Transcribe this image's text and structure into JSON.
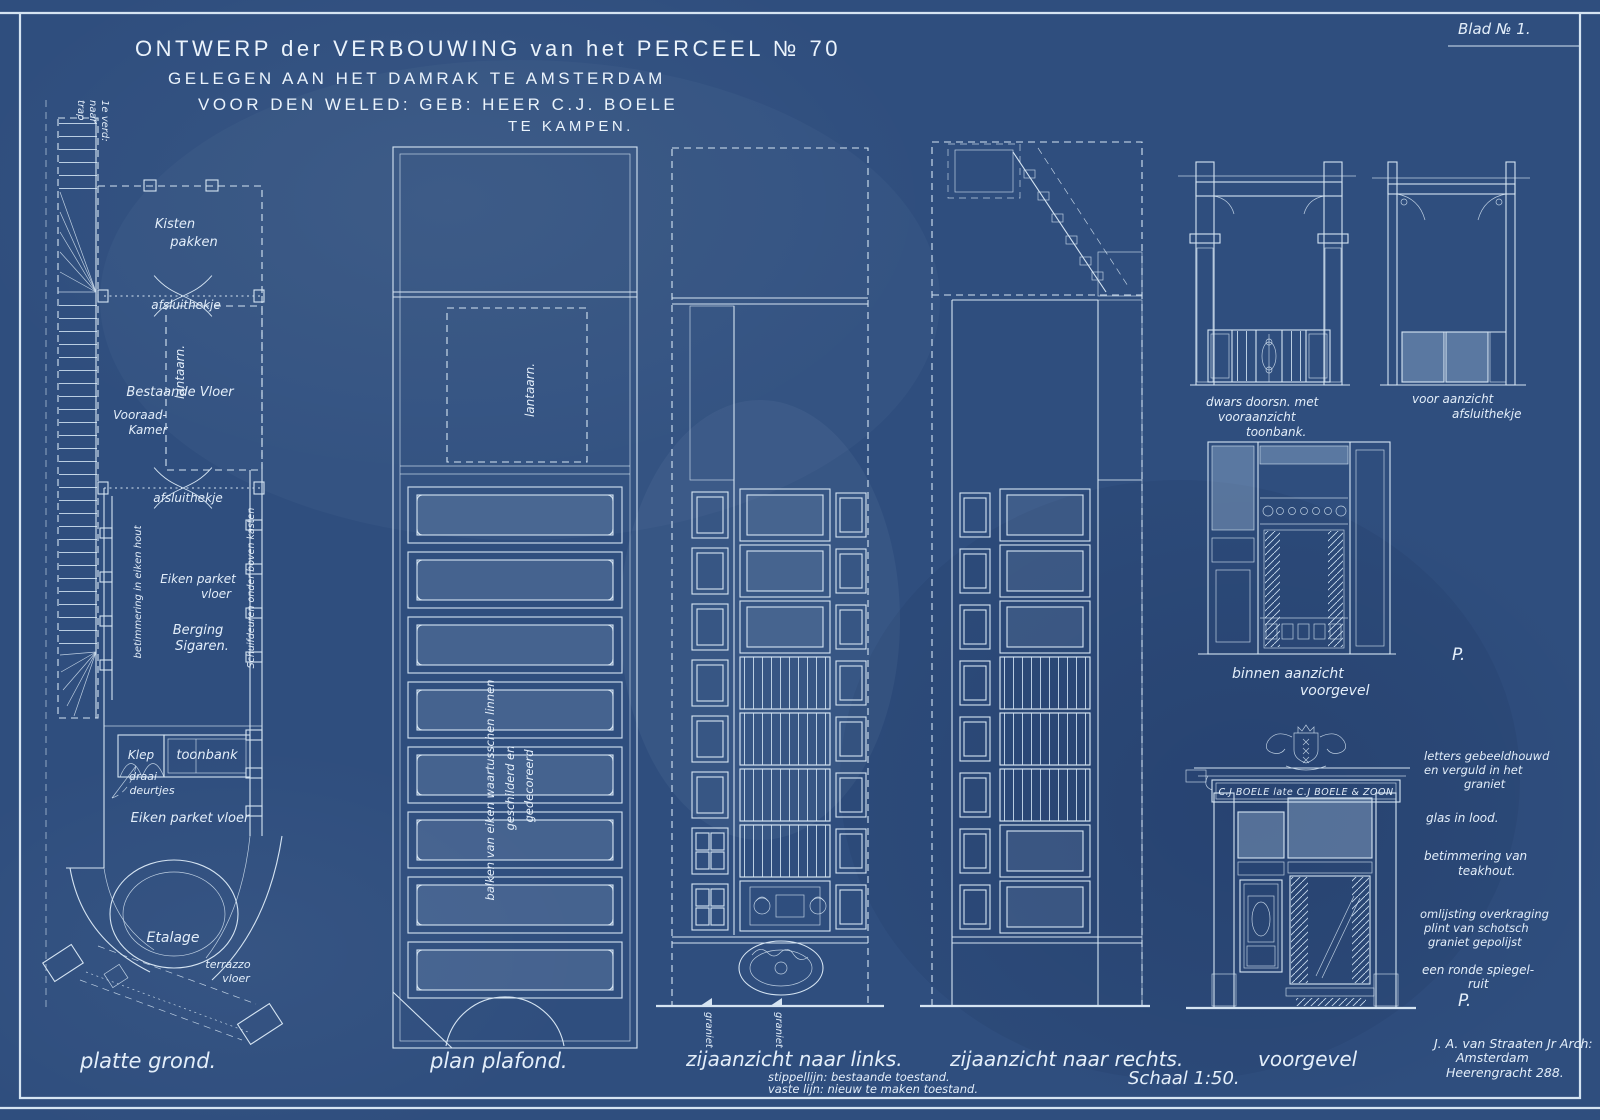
{
  "colors": {
    "paper": "#2f4e7e",
    "line": "#d5e4f2",
    "text": "#e3eefa"
  },
  "sheet": {
    "blad": "Blad № 1.",
    "title1": "ONTWERP der VERBOUWING van het PERCEEL № 70",
    "title2": "GELEGEN AAN HET DAMRAK TE AMSTERDAM",
    "title3": "VOOR DEN WELED: GEB: HEER C.J. BOELE",
    "title4": "TE KAMPEN."
  },
  "plan": {
    "caption": "platte grond.",
    "trap1": "trap",
    "trap2": "naar",
    "trap3": "1e verd:",
    "kisten1": "Kisten",
    "kisten2": "pakken",
    "hekje1": "afsluithekje",
    "lantaarn": "lantaarn.",
    "bestaand": "Bestaande Vloer",
    "voorraad1": "Vooraad-",
    "voorraad2": "Kamer",
    "hekje2": "afsluithekje",
    "betimmering": "betimmering in eiken hout",
    "parket1a": "Eiken parket",
    "parket1b": "vloer",
    "berging1": "Berging",
    "berging2": "Sigaren.",
    "schuif": "Schuifdeuren onder boven kasten",
    "klep": "Klep",
    "toonbank": "toonbank",
    "draai1": "draai-",
    "draai2": "deurtjes",
    "parket2": "Eiken parket vloer",
    "etalage": "Etalage",
    "terrazzo1": "terrazzo",
    "terrazzo2": "vloer"
  },
  "plafond": {
    "caption": "plan plafond.",
    "lantaarn": "lantaarn.",
    "balken1": "balken van eiken waartusschen linnen",
    "balken2": "geschilderd en",
    "balken3": "gedecoreerd"
  },
  "links": {
    "caption": "zijaanzicht naar links.",
    "note1": "stippellijn: bestaande toestand.",
    "note2": "vaste lijn: nieuw te maken toestand.",
    "graniet1": "graniet",
    "graniet2": "graniet"
  },
  "rechts": {
    "caption": "zijaanzicht naar rechts.",
    "schaal": "Schaal 1:50."
  },
  "details": {
    "toonbank1": "dwars doorsn. met",
    "toonbank2": "vooraanzicht",
    "toonbank3": "toonbank.",
    "hekje1": "voor aanzicht",
    "hekje2": "afsluithekje",
    "binnen1": "binnen aanzicht",
    "binnen2": "voorgevel",
    "p1": "P.",
    "p2": "P."
  },
  "voorgevel": {
    "caption": "voorgevel",
    "sign": "C.J BOELE late C.J BOELE & ZOON",
    "note1a": "letters gebeeldhouwd",
    "note1b": "en verguld in het",
    "note1c": "graniet",
    "note2": "glas in lood.",
    "note3a": "betimmering van",
    "note3b": "teakhout.",
    "note4a": "omlijsting overkraging",
    "note4b": "plint van schotsch",
    "note4c": "graniet gepolijst",
    "note5a": "een ronde spiegel-",
    "note5b": "ruit"
  },
  "architect": {
    "line1": "J. A. van Straaten Jr Arch:",
    "line2": "Amsterdam",
    "line3": "Heerengracht 288."
  }
}
